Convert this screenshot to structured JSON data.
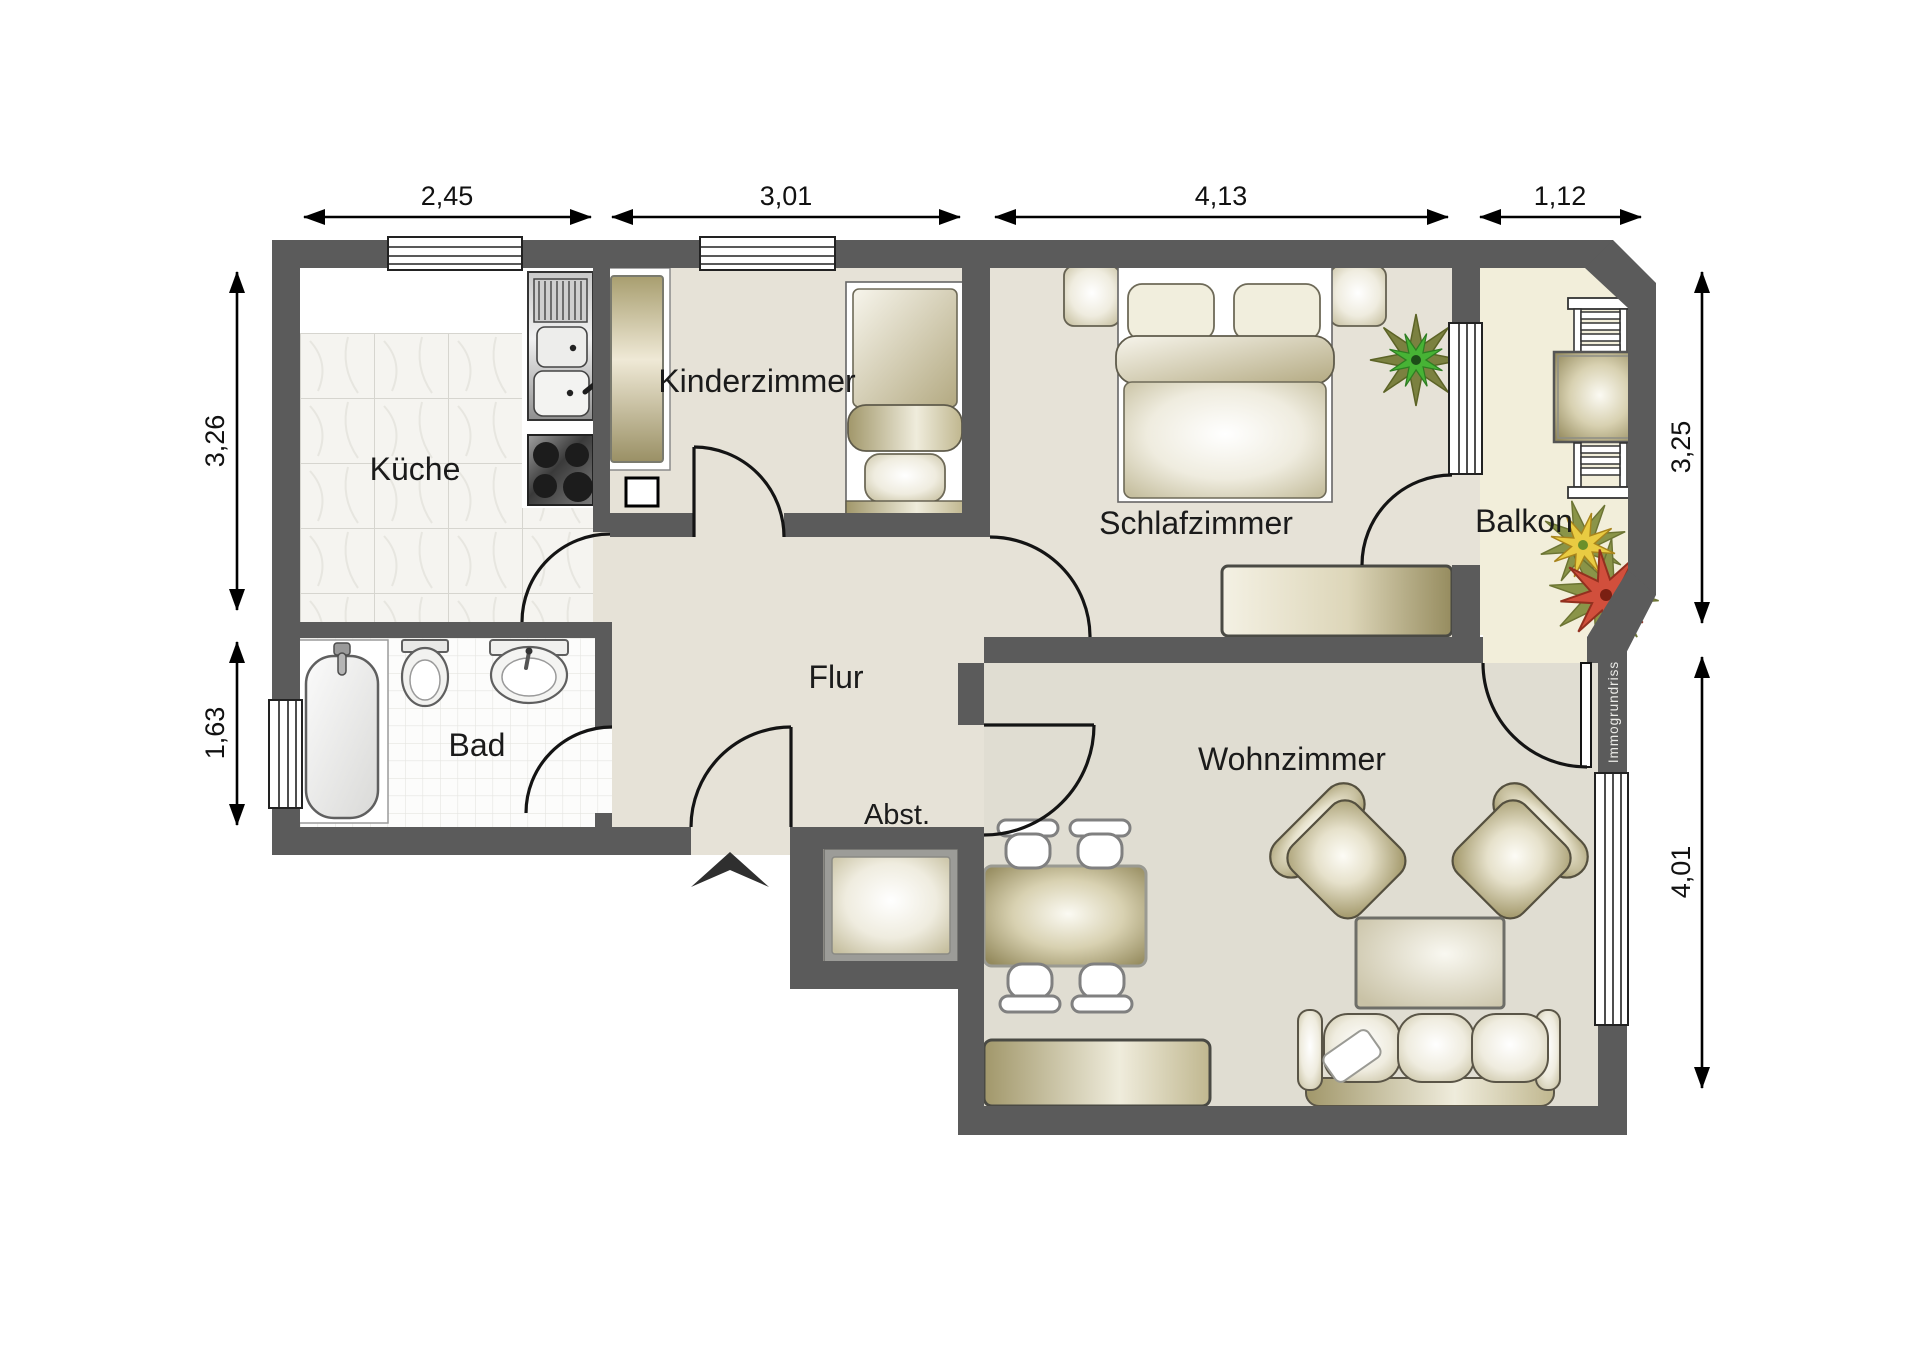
{
  "plan": {
    "rooms": {
      "kueche": {
        "label": "Küche"
      },
      "kinderzimmer": {
        "label": "Kinderzimmer"
      },
      "schlafzimmer": {
        "label": "Schlafzimmer"
      },
      "balkon": {
        "label": "Balkon"
      },
      "bad": {
        "label": "Bad"
      },
      "flur": {
        "label": "Flur"
      },
      "abstellraum": {
        "label": "Abst."
      },
      "wohnzimmer": {
        "label": "Wohnzimmer"
      }
    },
    "dimensions_m": {
      "top": [
        "2,45",
        "3,01",
        "4,13",
        "1,12"
      ],
      "left": [
        "3,26",
        "1,63"
      ],
      "right": [
        "3,25",
        "4,01"
      ]
    },
    "watermark": "Immogrundriss",
    "colors": {
      "wall": "#5b5b5b",
      "floor_beige": "#e6e2d7",
      "floor_wohnzimmer": "#e0ddd2",
      "floor_balkon": "#f2eeda",
      "furniture_khaki": "#9a9065"
    }
  }
}
